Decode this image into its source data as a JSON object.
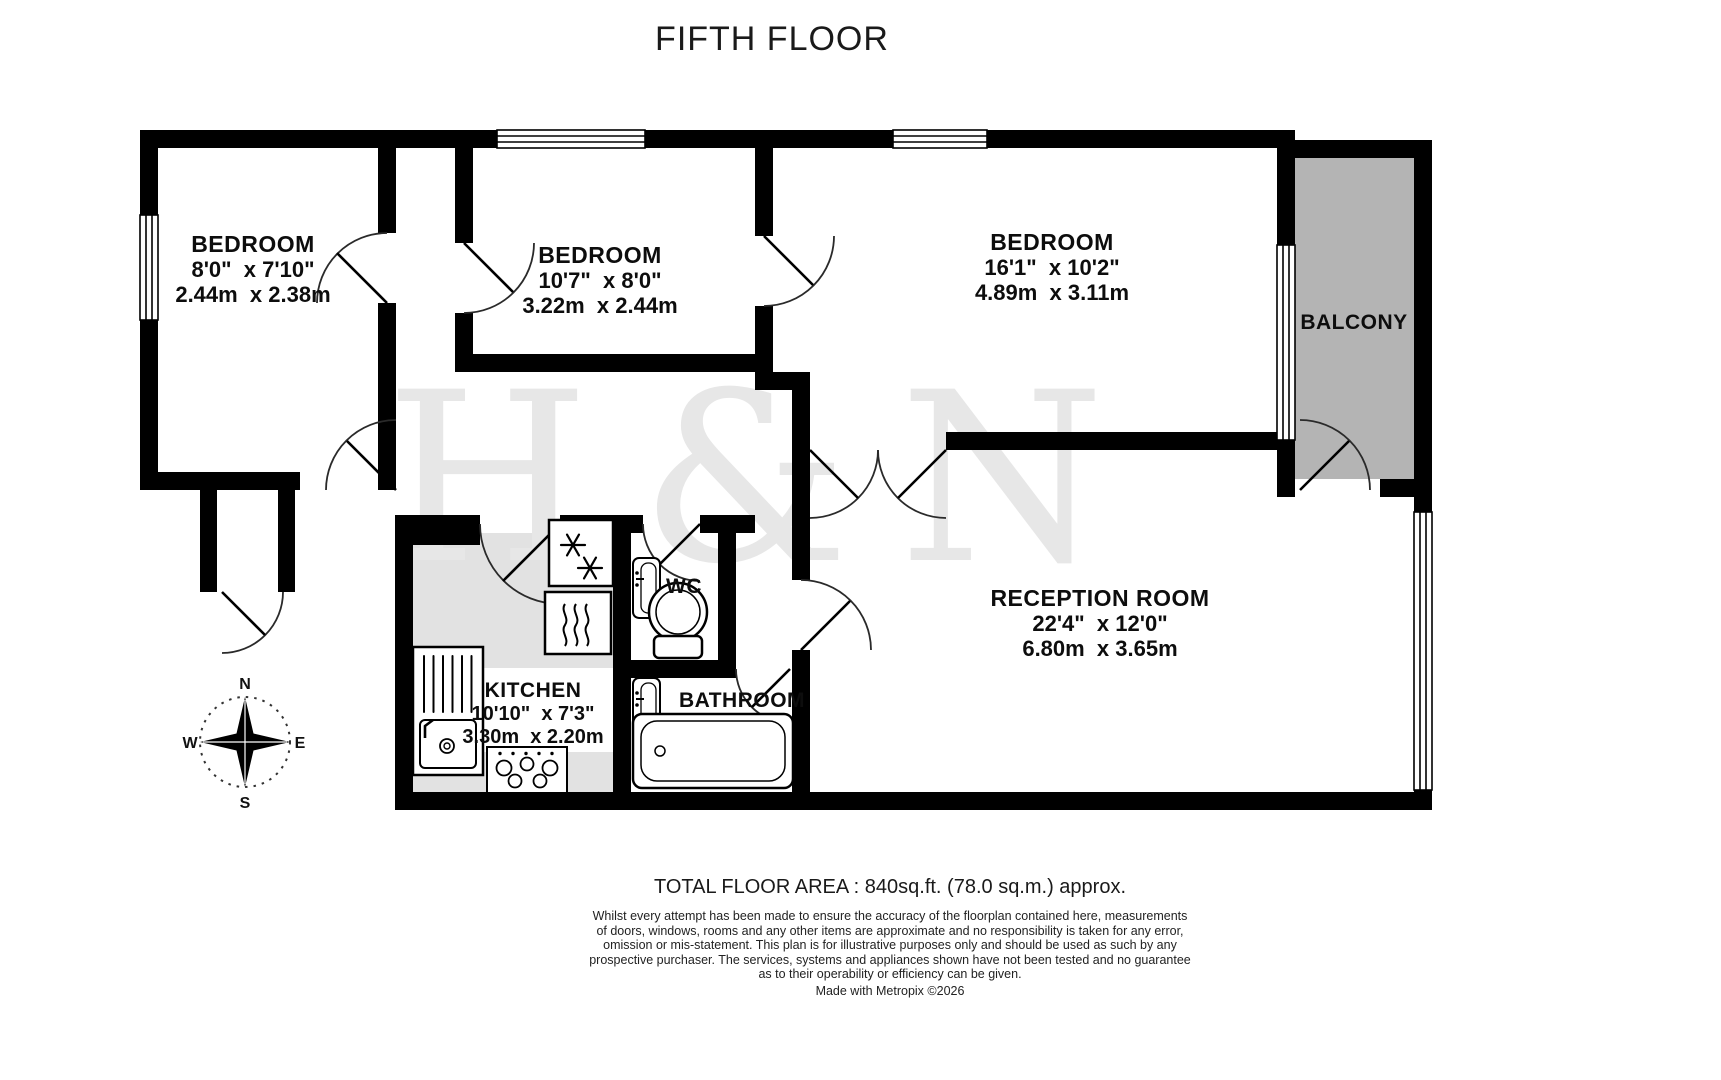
{
  "title": "FIFTH FLOOR",
  "watermark": "H&N",
  "rooms": {
    "bedroom1": {
      "name": "BEDROOM",
      "imperial": "8'0\"  x 7'10\"",
      "metric": "2.44m  x 2.38m"
    },
    "bedroom2": {
      "name": "BEDROOM",
      "imperial": "10'7\"  x 8'0\"",
      "metric": "3.22m  x 2.44m"
    },
    "bedroom3": {
      "name": "BEDROOM",
      "imperial": "16'1\"  x 10'2\"",
      "metric": "4.89m  x 3.11m"
    },
    "reception": {
      "name": "RECEPTION ROOM",
      "imperial": "22'4\"  x 12'0\"",
      "metric": "6.80m  x 3.65m"
    },
    "kitchen": {
      "name": "KITCHEN",
      "imperial": "10'10\"  x 7'3\"",
      "metric": "3.30m  x 2.20m"
    },
    "bathroom": {
      "name": "BATHROOM"
    },
    "wc": {
      "name": "WC"
    },
    "balcony": {
      "name": "BALCONY"
    }
  },
  "compass": {
    "north": "N",
    "east": "E",
    "south": "S",
    "west": "W"
  },
  "footer": {
    "total_area": "TOTAL FLOOR AREA : 840sq.ft. (78.0 sq.m.) approx.",
    "disclaimer_lines": [
      "Whilst every attempt has been made to ensure the accuracy of the floorplan contained here, measurements",
      "of doors, windows, rooms and any other items are approximate and no responsibility is taken for any error,",
      "omission or mis-statement. This plan is for illustrative purposes only and should be used as such by any",
      "prospective purchaser. The services, systems and appliances shown have not been tested and no guarantee",
      "as to their operability or efficiency can be given."
    ],
    "credit": "Made with Metropix ©2026"
  },
  "colors": {
    "wall": "#000000",
    "balcony_fill": "#b4b4b4",
    "kitchen_fill": "#e2e2e2",
    "watermark": "#e7e7e7"
  }
}
